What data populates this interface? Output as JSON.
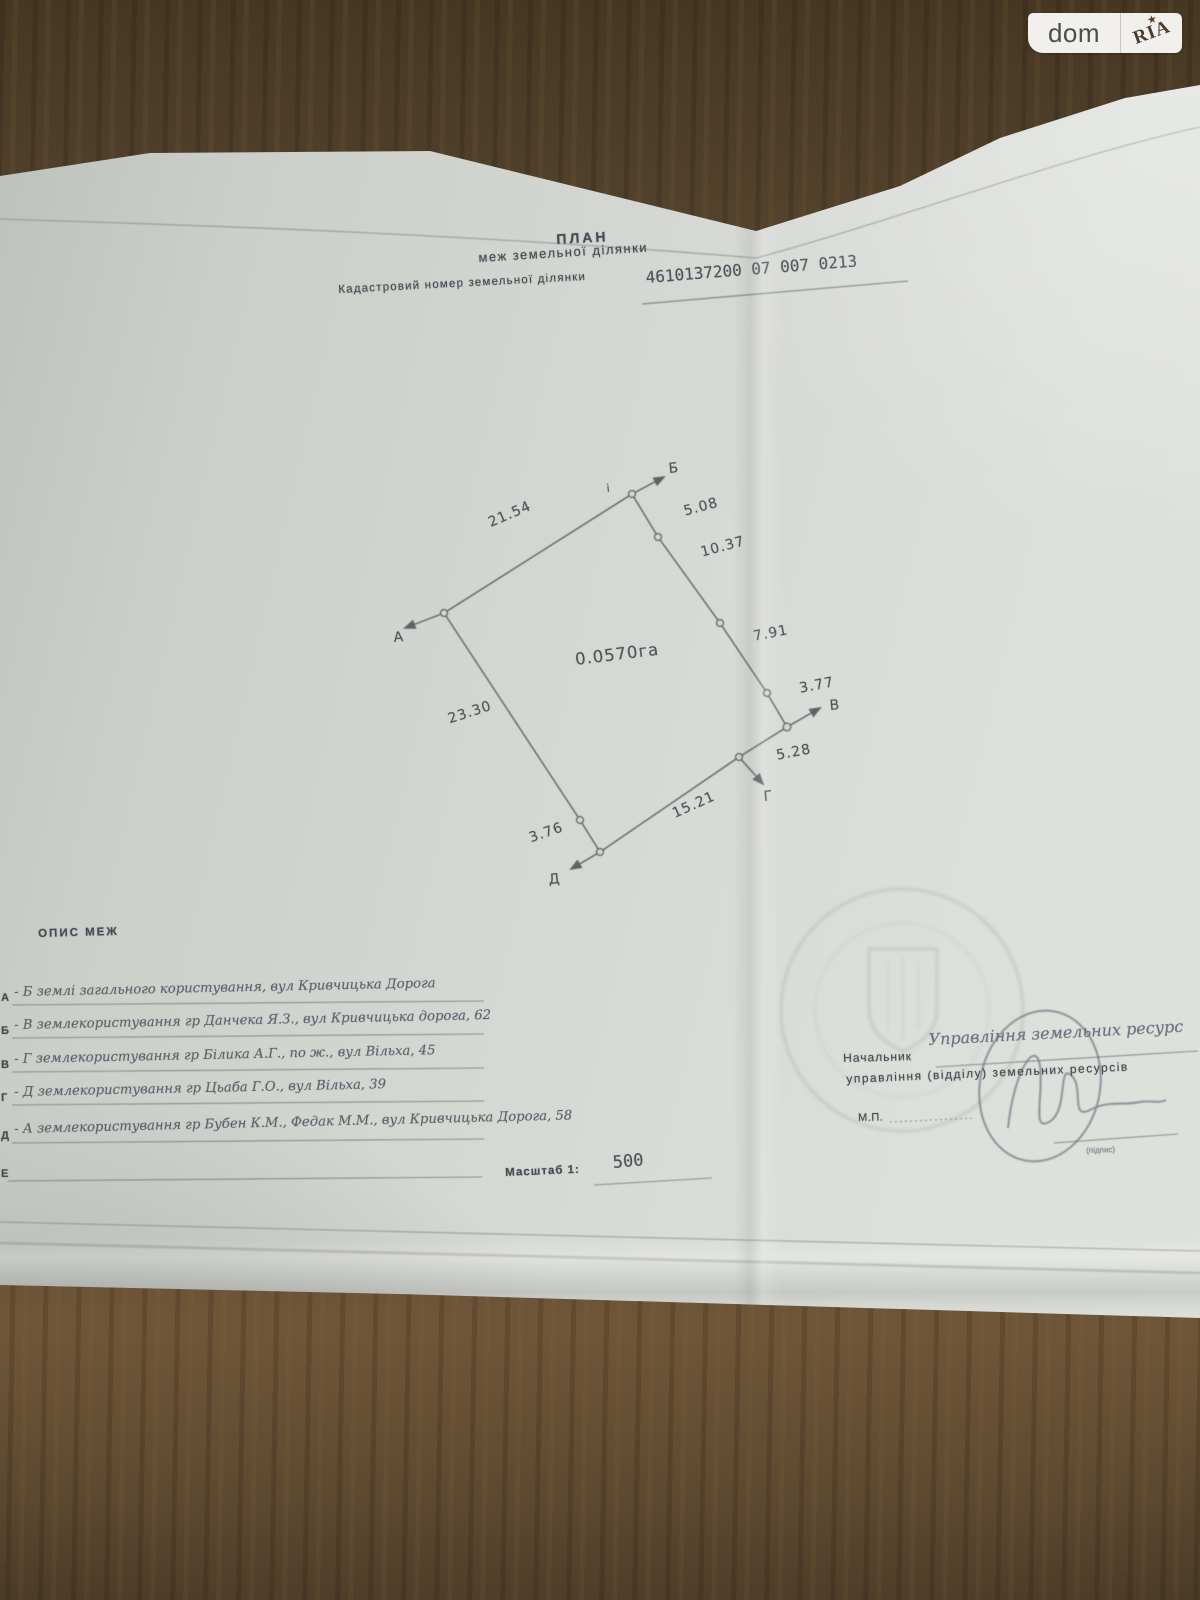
{
  "watermark": {
    "dom": "dom",
    "ria": "RIA",
    "star": "★"
  },
  "doc": {
    "title": "ПЛАН",
    "subtitle": "меж земельної ділянки",
    "cadastral_label": "Кадастровий номер земельної ділянки",
    "cadastral_number": "4610137200 07 007 0213"
  },
  "plot": {
    "area": "0.0570га",
    "tick": "і",
    "labels": {
      "A": "А",
      "B": "Б",
      "V": "В",
      "G": "Г",
      "D": "Д"
    },
    "lengths": {
      "ab": "21.54",
      "s1": "5.08",
      "s2": "10.37",
      "s3": "7.91",
      "s4": "3.77",
      "s5": "5.28",
      "s6": "15.21",
      "s7": "3.76",
      "da": "23.30"
    }
  },
  "legend": {
    "heading": "ОПИС МЕЖ",
    "rows": [
      {
        "letter": "А",
        "text": "- Б землі загального користування, вул Кривчицька Дорога"
      },
      {
        "letter": "Б",
        "text": "- В землекористування гр Данчека Я.З., вул Кривчицька дорога, 62"
      },
      {
        "letter": "В",
        "text": "- Г землекористування гр Білика А.Г., по ж., вул Вільха, 45"
      },
      {
        "letter": "Г",
        "text": "- Д землекористування гр Цьаба Г.О., вул Вільха, 39"
      },
      {
        "letter": "Д",
        "text": "- А землекористування гр Бубен К.М., Федак М.М., вул Кривчицька Дорога, 58"
      },
      {
        "letter": "Е",
        "text": ""
      }
    ],
    "scale_label": "Масштаб 1:",
    "scale_value": "500"
  },
  "signature": {
    "chief_label": "Начальник",
    "chief_value": "Управління земельних ресурс",
    "dept_label": "управління (відділу) земельних ресурсів",
    "mp_label": "М.П.",
    "sign_caption": "(підпис)"
  }
}
